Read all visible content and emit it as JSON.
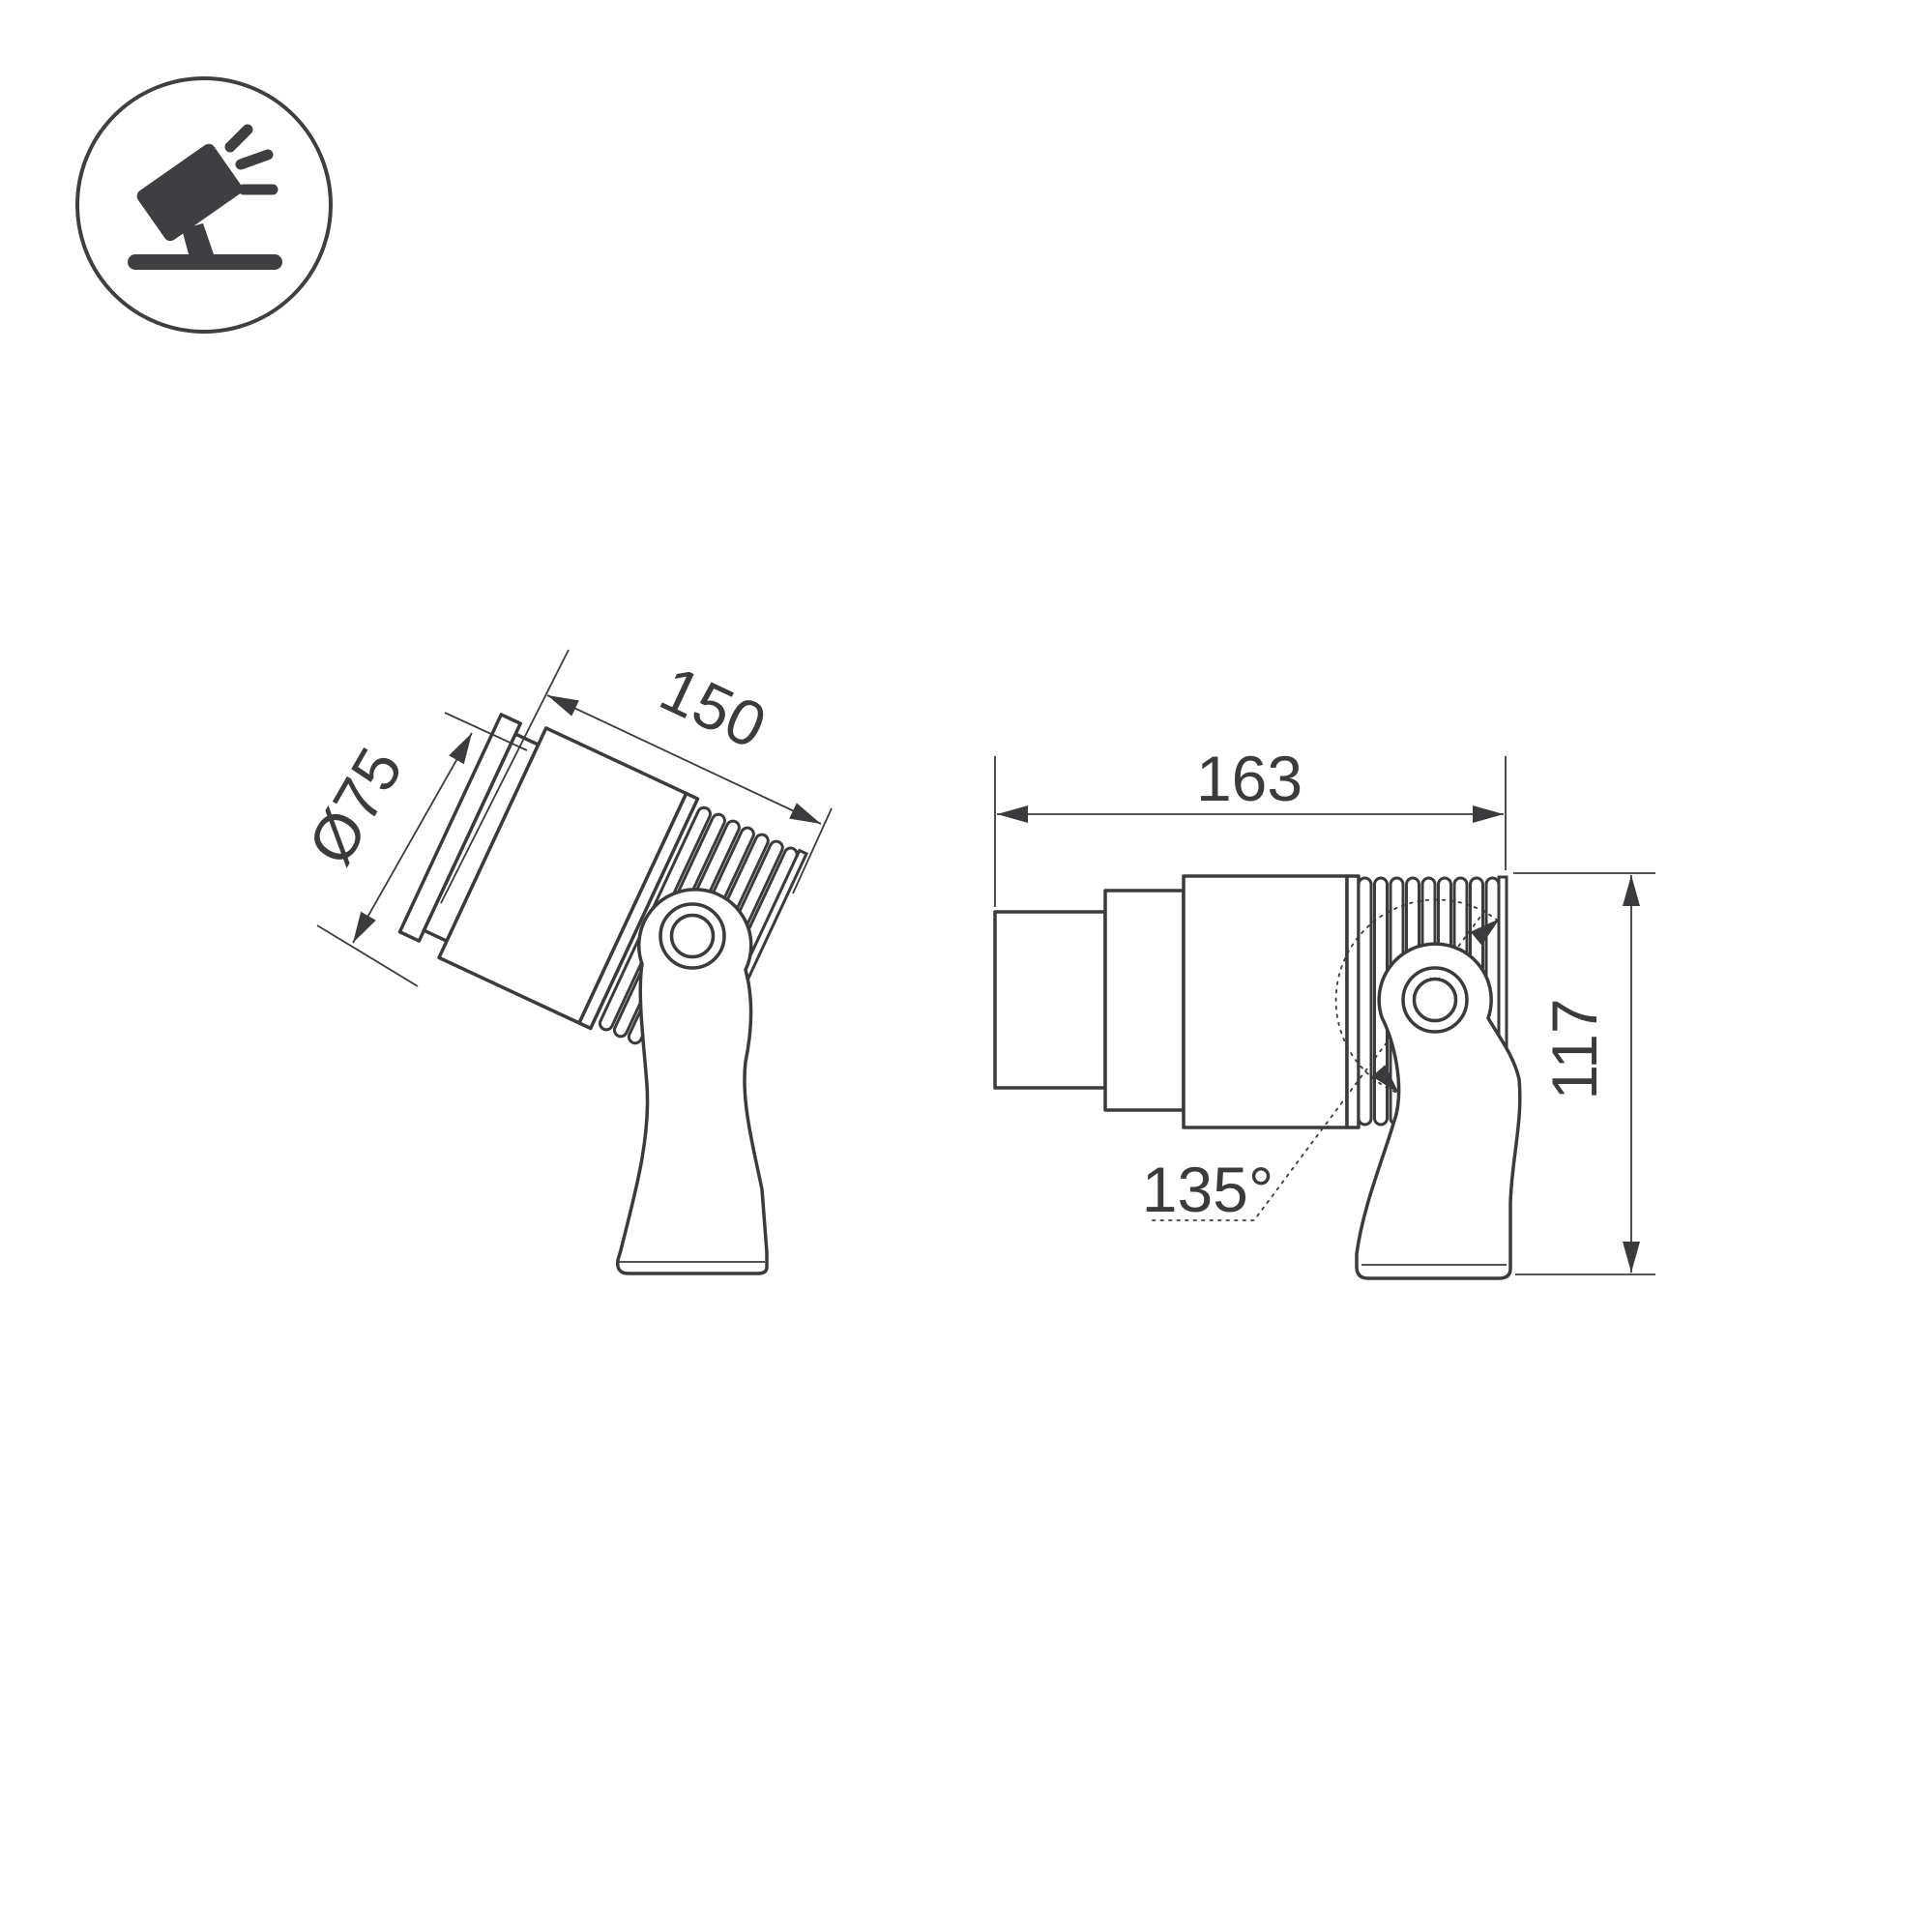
{
  "drawing": {
    "type": "technical-dimension-drawing",
    "background_color": "#ffffff",
    "line_color": "#3b3b3d",
    "icon_color": "#3f3f41",
    "icon": {
      "name": "tilted-spotlight-icon",
      "description": "spotlight tilted on stand pictogram in circle"
    },
    "views": {
      "left": {
        "name": "tilted-side-view",
        "tilt_degrees": 25,
        "labels": {
          "diameter": "Ø75",
          "length": "150"
        }
      },
      "right": {
        "name": "horizontal-side-view",
        "labels": {
          "width": "163",
          "height": "117",
          "swivel_angle": "135°"
        }
      }
    }
  }
}
